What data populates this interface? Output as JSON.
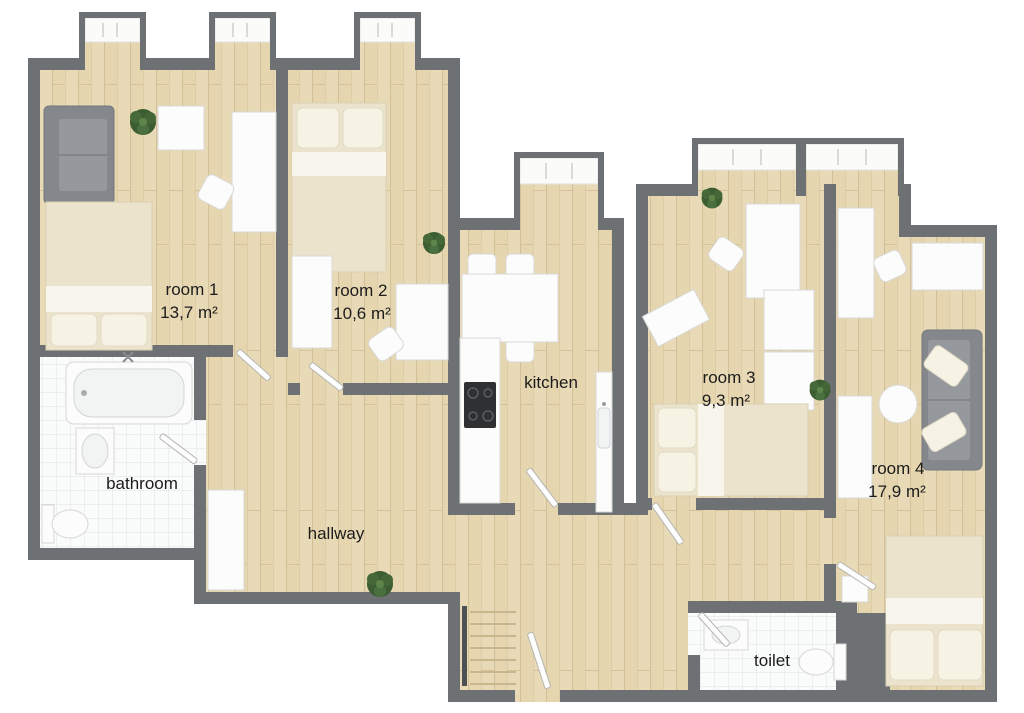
{
  "plan": {
    "type": "apartment-floor-plan-3d-top-view",
    "rooms": {
      "room1": {
        "label": "room 1",
        "area": "13,7 m²"
      },
      "room2": {
        "label": "room 2",
        "area": "10,6 m²"
      },
      "room3": {
        "label": "room 3",
        "area": "9,3 m²"
      },
      "room4": {
        "label": "room 4",
        "area": "17,9 m²"
      },
      "kitchen": {
        "label": "kitchen"
      },
      "bathroom": {
        "label": "bathroom"
      },
      "hallway": {
        "label": "hallway"
      },
      "toilet": {
        "label": "toilet"
      }
    },
    "furniture": {
      "room1": [
        "sofa",
        "double-bed",
        "dresser",
        "desk",
        "chair",
        "plant"
      ],
      "room2": [
        "double-bed",
        "wardrobe",
        "desk",
        "chair",
        "plant"
      ],
      "kitchen": [
        "dining-table",
        "four-chairs",
        "counter-with-cooktop",
        "counter-with-sink"
      ],
      "room3": [
        "desk",
        "chair",
        "side-table",
        "wardrobe",
        "double-bed",
        "plant",
        "plant"
      ],
      "room4": [
        "desk",
        "chair",
        "sideboard",
        "sofa",
        "round-coffee-table",
        "wardrobe",
        "nightstand",
        "double-bed"
      ],
      "bathroom": [
        "bathtub",
        "sink",
        "toilet"
      ],
      "toilet": [
        "sink",
        "toilet"
      ],
      "hallway": [
        "wardrobe",
        "plant",
        "staircase",
        "entrance-door"
      ]
    },
    "window_bays": 6,
    "colors": {
      "wall": "#6e7174",
      "floor_wood": "#e9dab7",
      "floor_tile": "#fafbfb",
      "bed": "#ebe3cc",
      "sofa": "#84878b",
      "furniture_white": "#fcfcfc",
      "plant": "#3c5c31",
      "label_text": "#1c1c1c",
      "background": "#ffffff"
    }
  }
}
